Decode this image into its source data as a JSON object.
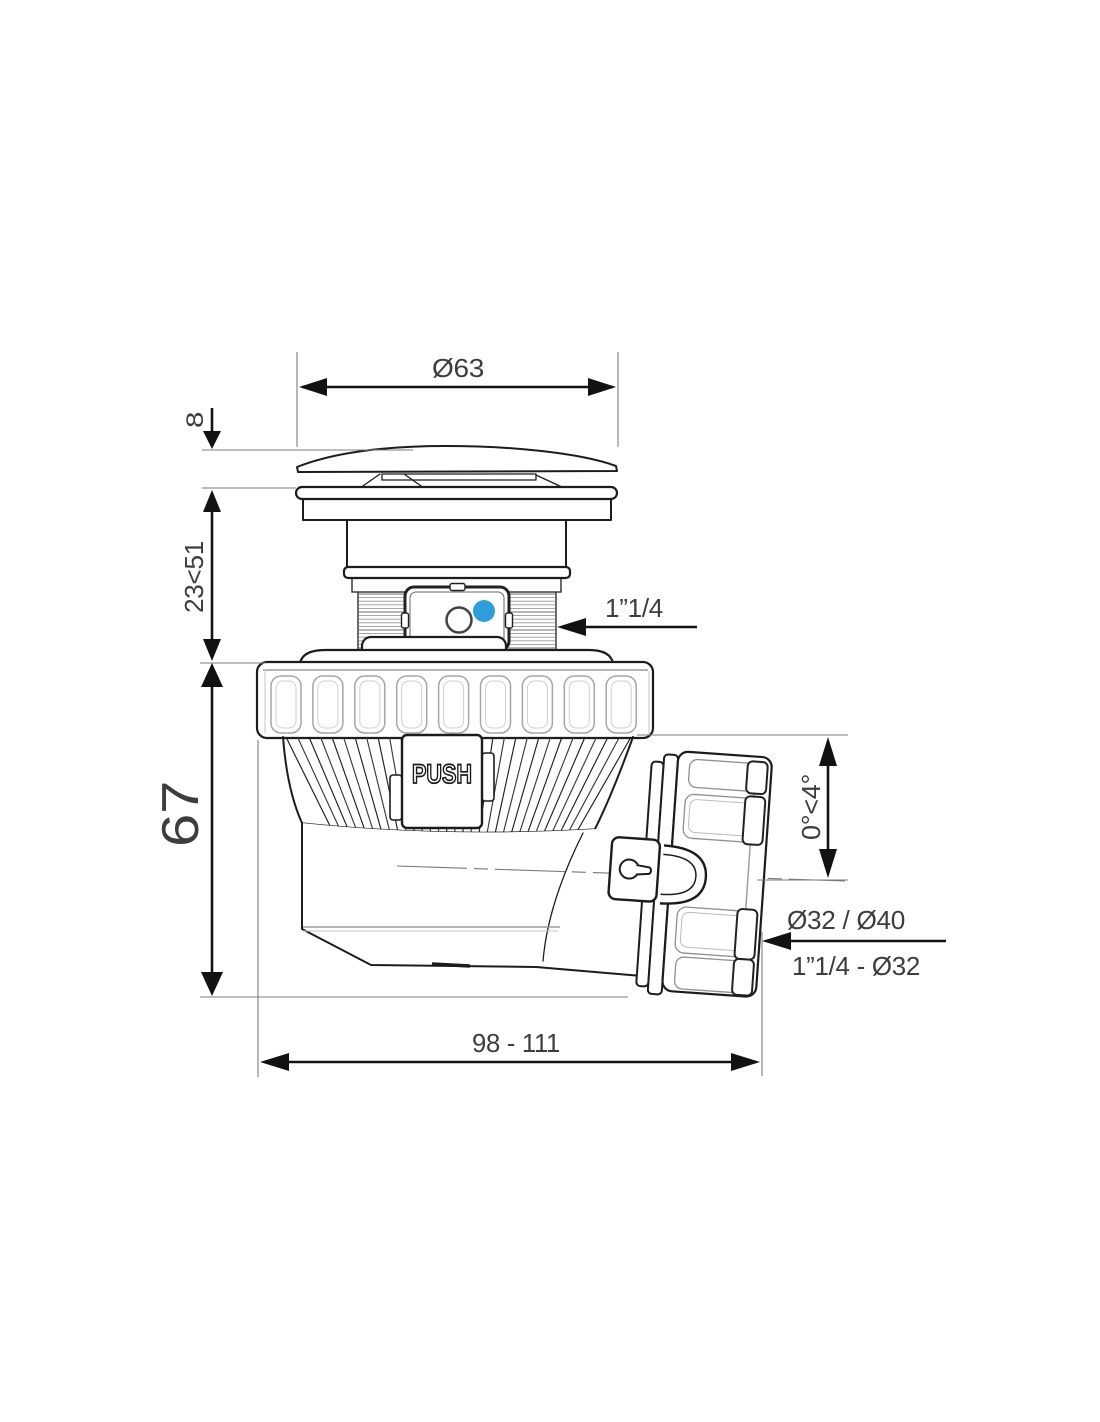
{
  "drawing": {
    "type": "technical-drawing",
    "subject": "pop-up bathtub waste with adjustable swivel outlet",
    "push_label": "PUSH",
    "accent_color": "#2d9ddb",
    "line_color": "#1c1c1c",
    "label_color": "#3d3d3d",
    "dimensions": {
      "cap_diameter": "Ø63",
      "cap_height": "8",
      "adjustment_height": "23<51",
      "body_height": "67",
      "inlet_thread": "1”1/4",
      "outlet_angle": "0°<4°",
      "outlet_diameters": "Ø32 / Ø40",
      "outlet_reduction": "1”1/4 - Ø32",
      "overall_length": "98 - 111"
    }
  }
}
